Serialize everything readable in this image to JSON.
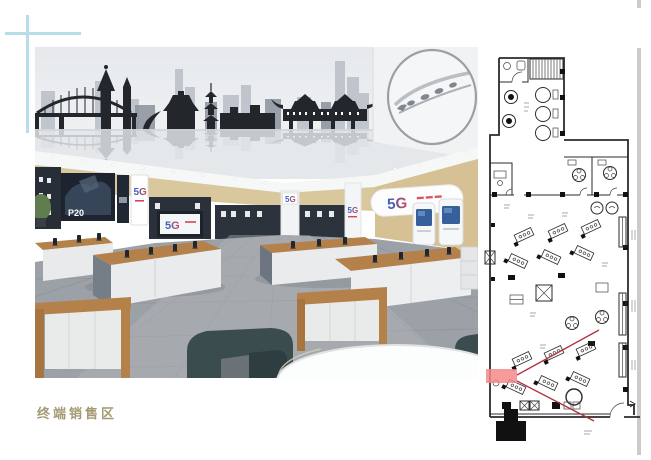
{
  "page": {
    "background": "#ffffff"
  },
  "decor": {
    "crosshair_color": "#b7dde8",
    "page_edge_line_color": "#cbcbcb"
  },
  "caption": {
    "text": "终端销售区",
    "color": "#a39a73"
  },
  "rendering": {
    "signs": {
      "five_g": "5G",
      "p20": "P20"
    },
    "colors": {
      "wall_tan": "#d9c79d",
      "mural_dark": "#23262b",
      "mural_mid_gray": "#b9bfc7",
      "wood": "#b5814a",
      "chair_teal": "#3a4c4e",
      "floor_gray": "#9ba1a6",
      "logo_blue": "#2468c8",
      "logo_red": "#d04858"
    }
  },
  "floor_plan": {
    "line_color": "#2b2b2b",
    "highlight_color": "#f58989",
    "sightline_color": "#b03340"
  }
}
